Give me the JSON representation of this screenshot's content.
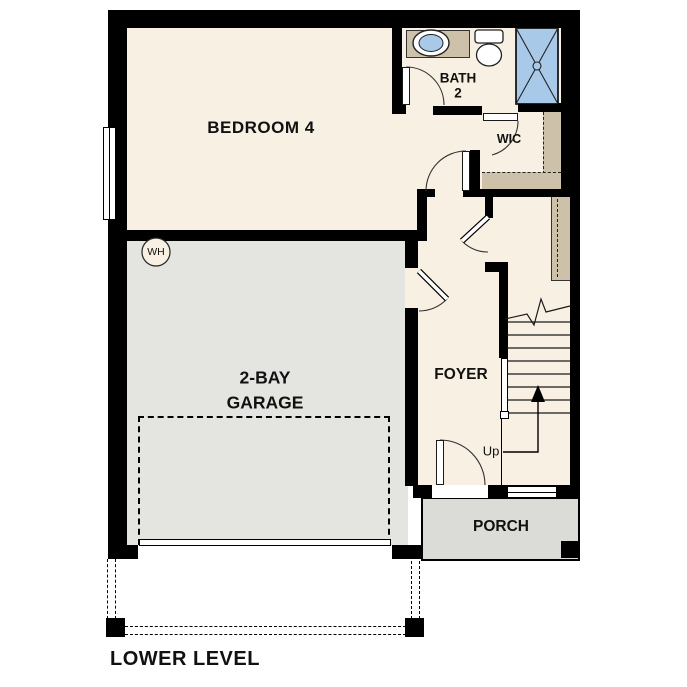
{
  "title": "LOWER LEVEL",
  "rooms": {
    "bedroom": "BEDROOM 4",
    "bath_line1": "BATH",
    "bath_line2": "2",
    "wic": "WIC",
    "garage_line1": "2-BAY",
    "garage_line2": "GARAGE",
    "foyer": "FOYER",
    "porch": "PORCH"
  },
  "annotations": {
    "up": "Up",
    "water_heater": "WH"
  },
  "palette": {
    "wall": "#000000",
    "floor_cream": "#F7F0E3",
    "garage_gray": "#E4E4E1",
    "porch_gray": "#DBDBD7",
    "cabinet_tan": "#CDC1A9",
    "fixture_blue": "#A9C9E9",
    "line": "#1a1a1a"
  }
}
